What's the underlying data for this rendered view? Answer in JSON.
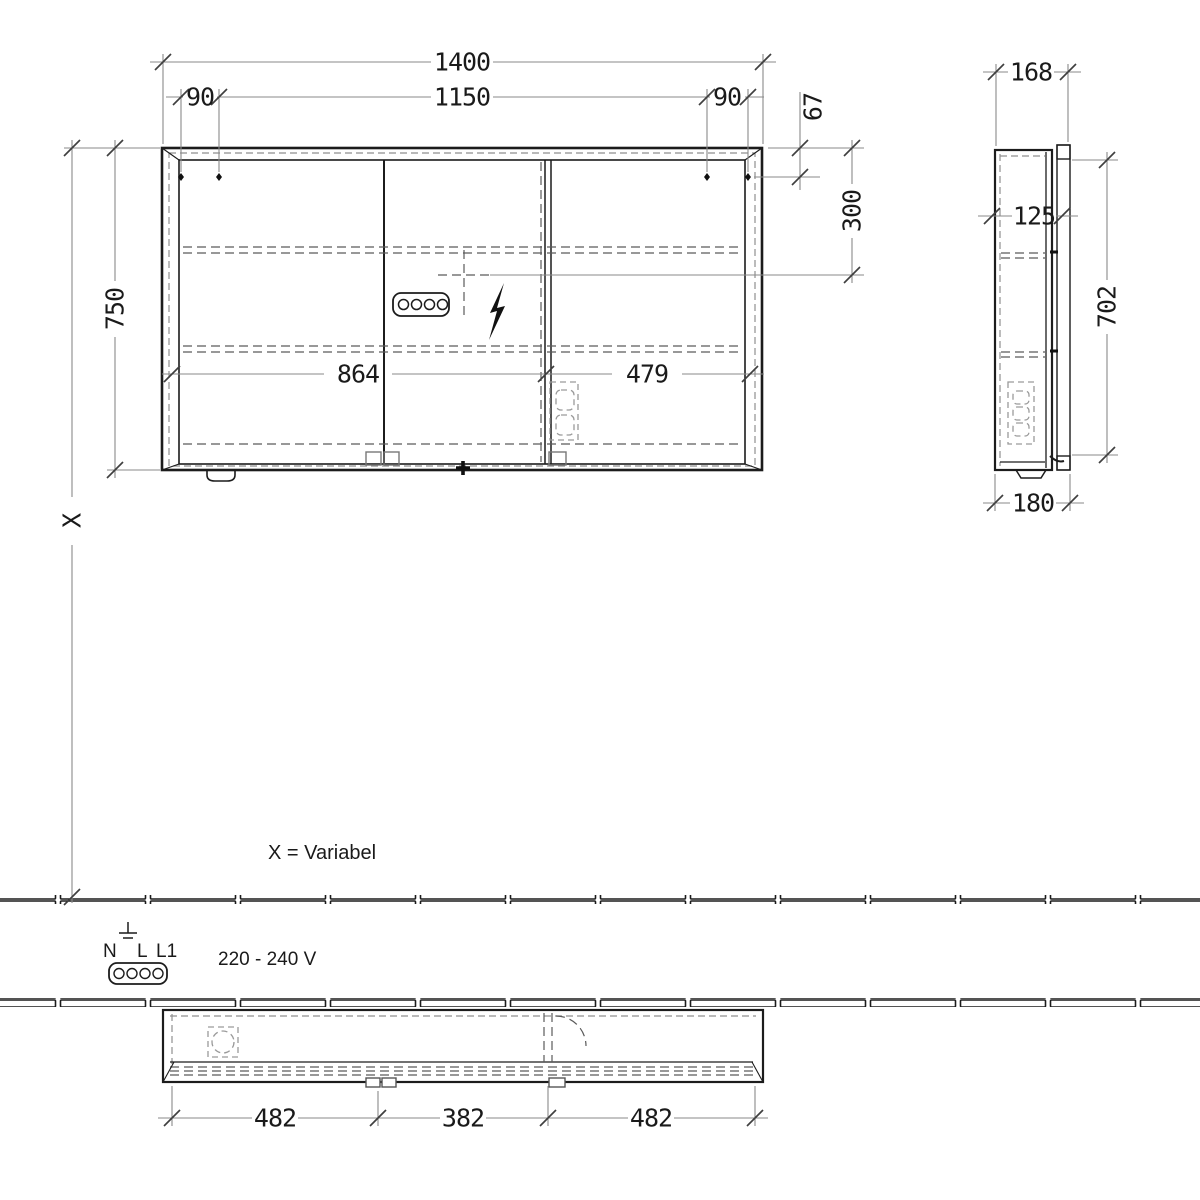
{
  "front_view": {
    "width_total": "1400",
    "width_inner": "1150",
    "hole_spacing_left": "90",
    "hole_spacing_right": "90",
    "height": "750",
    "top_to_holes": "67",
    "top_to_connection": "300",
    "door_width_left": "864",
    "door_width_right": "479",
    "height_to_wall": "X"
  },
  "side_view": {
    "depth": "168",
    "inner_depth": "125",
    "door_height": "702",
    "total_depth": "180"
  },
  "bottom_view": {
    "segment_left": "482",
    "segment_middle": "382",
    "segment_right": "482"
  },
  "notes": {
    "variable_note": "X = Variabel",
    "voltage": "220 - 240 V",
    "terminal_n": "N",
    "terminal_l": "L",
    "terminal_l1": "L1"
  },
  "icons": {
    "power_socket": "socket-icon",
    "lightning_bolt": "lightning-bolt-icon",
    "ground": "ground-icon",
    "crosshair": "crosshair-icon",
    "door_swing": "door-swing-arc-icon",
    "mounting_hole": "mounting-hole-icon",
    "tile_strip": "wall-tile-strip"
  },
  "colors": {
    "line": "#1c1c1c",
    "dimension": "#8a8a8a",
    "dashed": "#5a5a5a",
    "background": "#ffffff"
  }
}
